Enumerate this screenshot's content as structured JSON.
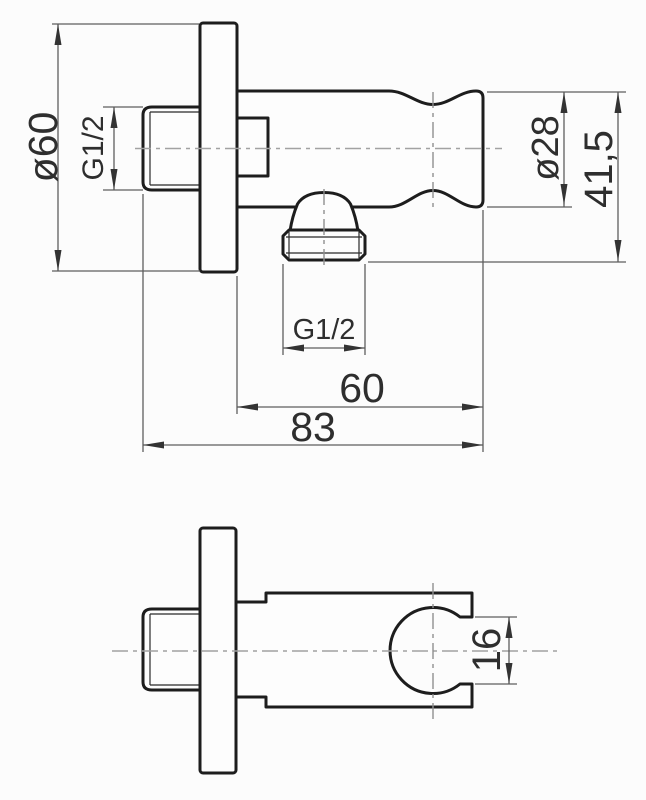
{
  "drawing": {
    "kind": "technical-dimension-drawing",
    "colors": {
      "background": "#fcfcfc",
      "outline": "#1d1d1d",
      "dimension_lines": "#5e5e5e",
      "centerlines": "#a2a2a2",
      "text": "#2e2e2e"
    },
    "front_view": {
      "labels": {
        "plate_diameter": "ø60",
        "wall_thread": "G1/2",
        "holder_diameter": "ø28",
        "holder_to_outlet_height": "41,5",
        "outlet_thread": "G1/2",
        "wall_to_holder_depth": "60",
        "overall_depth": "83"
      }
    },
    "bottom_view": {
      "labels": {
        "slot_width": "16"
      }
    }
  }
}
